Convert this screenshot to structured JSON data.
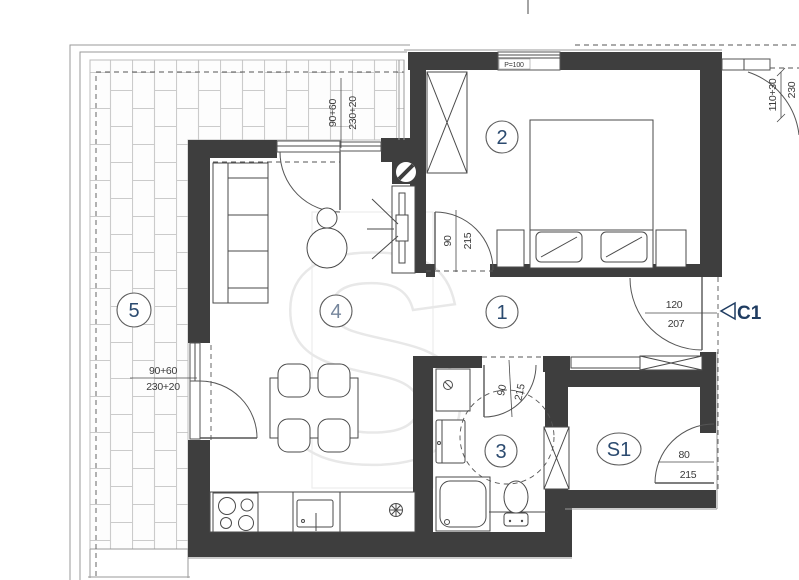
{
  "watermark": {
    "letter": "S"
  },
  "rooms": {
    "hall": {
      "label": "1"
    },
    "bedroom": {
      "label": "2"
    },
    "bathroom": {
      "label": "3"
    },
    "living": {
      "label": "4"
    },
    "terrace": {
      "label": "5"
    },
    "storage": {
      "label": "S1"
    }
  },
  "entry": {
    "marker": "C1"
  },
  "window": {
    "parapet_label": "P=100"
  },
  "dimensions": {
    "terrace_door_top": {
      "top": "90+60",
      "bottom": "230+20"
    },
    "terrace_door_left": {
      "top": "90+60",
      "bottom": "230+20"
    },
    "balcony_door_right": {
      "top": "110+30",
      "bottom": "230"
    },
    "bedroom_door": {
      "top": "90",
      "bottom": "215"
    },
    "bathroom_door": {
      "top": "90",
      "bottom": "215"
    },
    "entry_door": {
      "top": "120",
      "bottom": "207"
    },
    "storage_door": {
      "top": "80",
      "bottom": "215"
    }
  },
  "colors": {
    "wall": "#3e3e3e",
    "line": "#4a4a4a",
    "dim_text": "#3a3a3a",
    "room_label": "#2b4a6f",
    "room_label_light": "#76869c",
    "accent_navy": "#1f3c61",
    "tile_joint": "#cbcbcb",
    "watermark": "#e8e8e8"
  }
}
